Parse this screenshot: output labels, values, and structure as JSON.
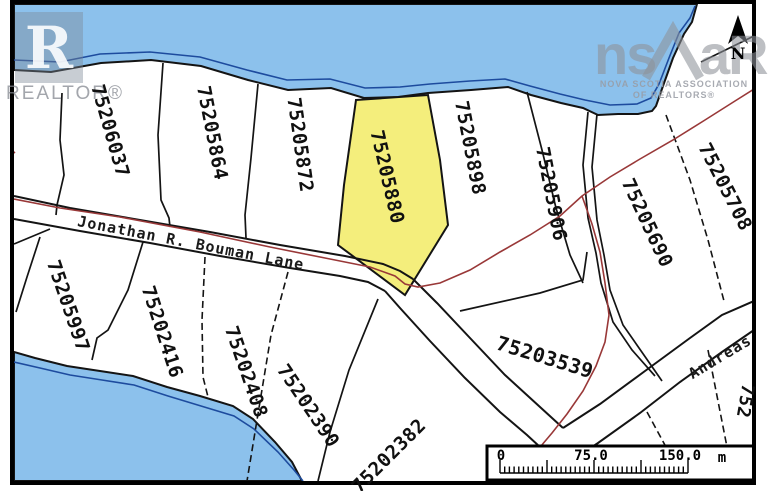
{
  "map": {
    "parcels": [
      {
        "id": "75206037",
        "highlighted": false
      },
      {
        "id": "75205864",
        "highlighted": false
      },
      {
        "id": "75205872",
        "highlighted": false
      },
      {
        "id": "75205880",
        "highlighted": true
      },
      {
        "id": "75205898",
        "highlighted": false
      },
      {
        "id": "75205906",
        "highlighted": false
      },
      {
        "id": "75205690",
        "highlighted": false
      },
      {
        "id": "75205708",
        "highlighted": false
      },
      {
        "id": "75205997",
        "highlighted": false
      },
      {
        "id": "75202416",
        "highlighted": false
      },
      {
        "id": "75202408",
        "highlighted": false
      },
      {
        "id": "75202390",
        "highlighted": false
      },
      {
        "id": "75202382",
        "highlighted": false
      },
      {
        "id": "75203539",
        "highlighted": false
      },
      {
        "id": "752",
        "highlighted": false,
        "partial": true
      }
    ],
    "roads": [
      {
        "name": "Jonathan R. Bouman Lane"
      },
      {
        "name": "Andreas"
      }
    ]
  },
  "scale_bar": {
    "start_label": "0",
    "mid_label": "75.0",
    "end_label": "150.0",
    "unit_label": "m"
  },
  "compass": {
    "label": "N"
  },
  "watermarks": {
    "realtor_block_letter": "R",
    "realtor_text": "REALTOR®",
    "nsar_ns": "ns",
    "nsar_ar": "aR",
    "nsar_line1": "NOVA SCOTIA ASSOCIATION",
    "nsar_line2": "OF REALTORS®"
  },
  "colors": {
    "water": "#8CC1EC",
    "water-line": "#1D4B9E",
    "parcel-line": "#141414",
    "red-line": "#993838",
    "highlight": "#F4EE7C",
    "frame": "#000000"
  }
}
